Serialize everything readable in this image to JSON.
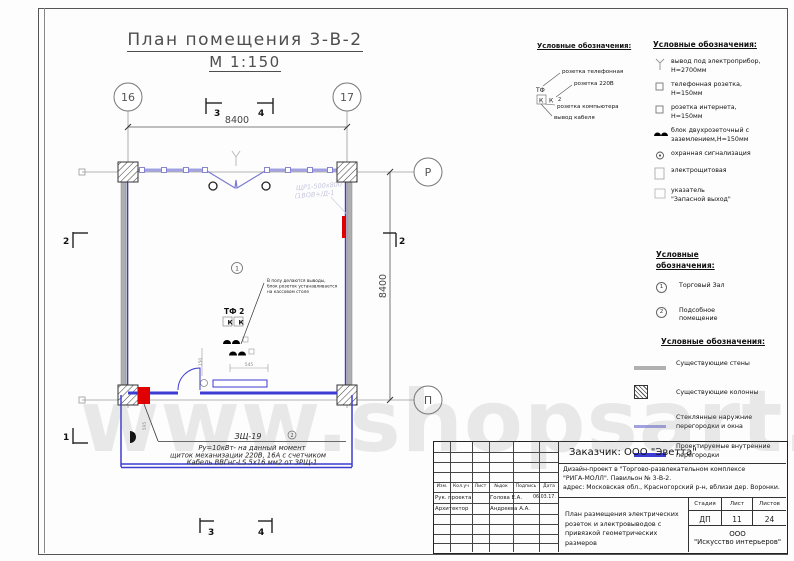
{
  "watermark": "www.shopsart.ru",
  "title": {
    "line1": "План помещения 3-В-2",
    "line2": "М 1:150"
  },
  "axes": {
    "c16": "16",
    "c17": "17",
    "cR": "Р",
    "cP": "П"
  },
  "dims": {
    "top": "8400",
    "right": "8400",
    "marker_top_left": "3",
    "marker_top_right": "4",
    "marker_right": "2",
    "marker_left_top": "2",
    "marker_left_bottom": "1",
    "marker_bottom_left": "3",
    "marker_bottom_right": "4",
    "d545": "545",
    "d150": "150",
    "d595": "595"
  },
  "plan": {
    "room_number": "1",
    "tf2_label": "ТФ 2",
    "k_left": "К",
    "k_right": "К",
    "faint_line1": "ЩР1-500х800",
    "faint_line2": "(1ВОВ+/Д-1",
    "tiny1": "В полу делаются выводы,",
    "tiny2": "блок розеток устанавливается",
    "tiny3": "на кассовом столе",
    "panel_label": "ЗЩ-19",
    "panel_badge": "2",
    "note_line1": "Ру=10кВт- на данный момент",
    "note_line2": "щиток механизации 220В, 16А с счетчиком",
    "note_line3": "Кабель ВВГнг-LS 5х16 мм2 от ЗРЩ-1"
  },
  "legend_sockets": {
    "title": "Условные обозначения:",
    "sym_tf": "ТФ",
    "sym_k1": "К",
    "sym_k2": "К",
    "sym_2": "2",
    "label_phone": "розетка телефонная",
    "label_220": "розетка 220В",
    "label_comp": "розетка компьютера",
    "label_cable": "вывод кабеля"
  },
  "legend_electrical": {
    "title": "Условные обозначения:",
    "items": [
      "вывод под электроприбор,\nН=2700мм",
      "телефонная розетка,\nН=150мм",
      "розетка интернета,\nН=150мм",
      "блок двухрозеточный с\nзаземлением,Н=150мм",
      "охранная сигнализация",
      "электрощитовая",
      "указатель\n\"Запасной выход\""
    ]
  },
  "legend_rooms": {
    "title": "Условные\nобозначения:",
    "num1": "1",
    "label1": "Торговый Зал",
    "num2": "2",
    "label2": "Подсобное\nпомещение"
  },
  "legend_walls": {
    "title": "Условные обозначения:",
    "items": [
      "Существующие стены",
      "Существующие колонны",
      "Стеклянные наружние\nперегородки и окна",
      "Проектируемые внутренние\nперегородки"
    ]
  },
  "titleblock": {
    "customer": "Заказчик:  ООО \"Эветта\"",
    "project_line1": "Дизайн-проект в  \"Торгово-развлекательном комплексе",
    "project_line2": "\"РИГА-МОЛЛ\". Павильон № 3-В-2.",
    "project_line3": "адрес: Московская обл., Красногорский р-н, вблизи дер. Воронки.",
    "cols": [
      "Изм.",
      "Кол.уч",
      "Лист",
      "№док",
      "Подпись",
      "Дата"
    ],
    "row1_role": "Рук. проекта",
    "row1_name": "Голова Е.А.",
    "row1_date": "06.03.17.",
    "row2_role": "Архитектор",
    "row2_name": "Андреева А.А.",
    "stage_label": "Стадия",
    "sheet_label": "Лист",
    "sheets_label": "Листов",
    "stage": "ДП",
    "sheet": "11",
    "sheets": "24",
    "drawing_title": "План размещения электрических\nрозеток и электровыводов с\nпривязкой геометрических размеров",
    "company_line1": "ООО",
    "company_line2": "\"Искусство интерьеров\""
  },
  "colors": {
    "blue_partition": "#3c3cd2",
    "lavender_glass": "#a2a2e2",
    "gray_wall": "#aeaeae",
    "red_panel": "#e00000"
  }
}
